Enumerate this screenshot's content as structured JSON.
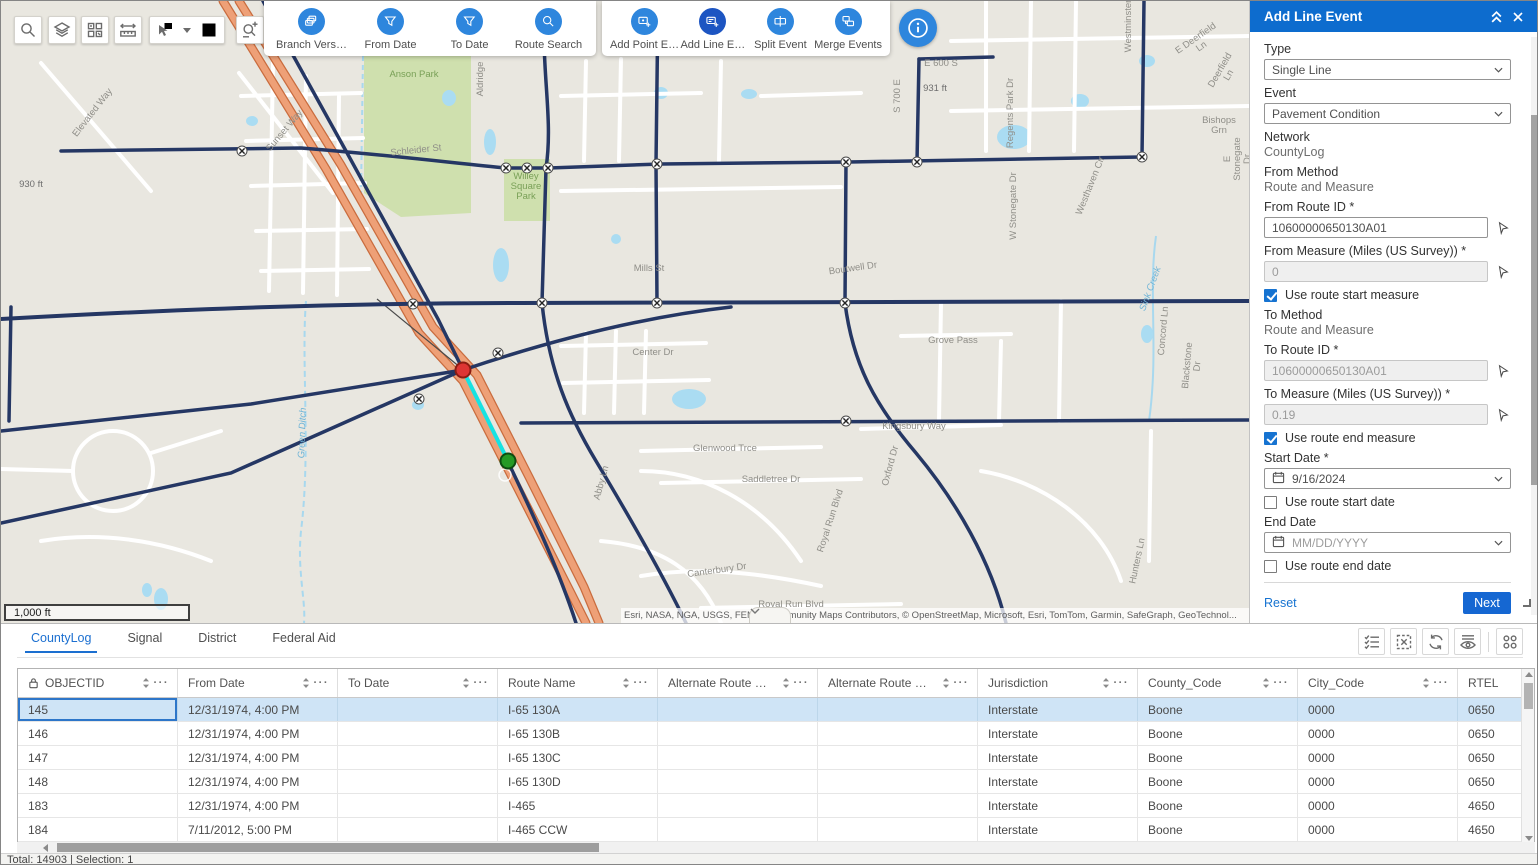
{
  "toolbar": {
    "left_tools": [
      "search-icon",
      "layers-icon",
      "basemap-grid-icon",
      "measure-icon",
      "select-icon",
      "clear-selection-icon",
      "route-sketch-icon"
    ],
    "filter_tools": [
      {
        "label": "Branch Vers…",
        "icon": "branch-version-icon"
      },
      {
        "label": "From Date",
        "icon": "filter-icon"
      },
      {
        "label": "To Date",
        "icon": "filter-icon"
      },
      {
        "label": "Route Search",
        "icon": "route-search-icon"
      }
    ],
    "event_tools": [
      {
        "label": "Add Point E…",
        "icon": "add-point-event-icon",
        "active": false
      },
      {
        "label": "Add Line E…",
        "icon": "add-line-event-icon",
        "active": true
      },
      {
        "label": "Split Event",
        "icon": "split-event-icon",
        "active": false
      },
      {
        "label": "Merge Events",
        "icon": "merge-events-icon",
        "active": false
      }
    ],
    "info_icon": "info-icon"
  },
  "map": {
    "scale_bar": "1,000 ft",
    "attribution": "Esri, NASA, NGA, USGS, FEMA | Community Maps Contributors, © OpenStreetMap, Microsoft, Esri, TomTom, Garmin, SafeGraph, GeoTechnol...",
    "labels": [
      {
        "text": "Elevated Way",
        "x": 92,
        "y": 112,
        "rot": -52,
        "cls": ""
      },
      {
        "text": "Sunset Way",
        "x": 284,
        "y": 130,
        "rot": -50,
        "cls": ""
      },
      {
        "text": "Anson Park",
        "x": 413,
        "y": 74,
        "rot": 0,
        "cls": "park"
      },
      {
        "text": "Aldridge",
        "x": 480,
        "y": 78,
        "rot": -90,
        "cls": ""
      },
      {
        "text": "Willey\nSquare\nPark",
        "x": 525,
        "y": 186,
        "rot": 0,
        "cls": "park"
      },
      {
        "text": "931 ft",
        "x": 934,
        "y": 88,
        "rot": 0,
        "cls": "elev"
      },
      {
        "text": "930 ft",
        "x": 30,
        "y": 184,
        "rot": 0,
        "cls": "elev"
      },
      {
        "text": "Schleider St",
        "x": 415,
        "y": 150,
        "rot": -6,
        "cls": ""
      },
      {
        "text": "Mills St",
        "x": 648,
        "y": 268,
        "rot": 0,
        "cls": ""
      },
      {
        "text": "Center Dr",
        "x": 652,
        "y": 352,
        "rot": 0,
        "cls": ""
      },
      {
        "text": "Boutwell Dr",
        "x": 852,
        "y": 268,
        "rot": -8,
        "cls": ""
      },
      {
        "text": "Grove Pass",
        "x": 952,
        "y": 340,
        "rot": 0,
        "cls": ""
      },
      {
        "text": "Kingsbury Way",
        "x": 913,
        "y": 426,
        "rot": 0,
        "cls": ""
      },
      {
        "text": "Glenwood Trce",
        "x": 724,
        "y": 448,
        "rot": 0,
        "cls": ""
      },
      {
        "text": "Saddletree Dr",
        "x": 770,
        "y": 479,
        "rot": 0,
        "cls": ""
      },
      {
        "text": "Abby Ln",
        "x": 601,
        "y": 482,
        "rot": -75,
        "cls": ""
      },
      {
        "text": "Canterbury Dr",
        "x": 716,
        "y": 570,
        "rot": -8,
        "cls": ""
      },
      {
        "text": "Royal Run Blvd",
        "x": 790,
        "y": 604,
        "rot": 0,
        "cls": ""
      },
      {
        "text": "Royal Run Blvd",
        "x": 830,
        "y": 520,
        "rot": -72,
        "cls": ""
      },
      {
        "text": "Oxford Dr",
        "x": 890,
        "y": 465,
        "rot": -75,
        "cls": ""
      },
      {
        "text": "Hunters Ln",
        "x": 1137,
        "y": 560,
        "rot": -78,
        "cls": ""
      },
      {
        "text": "S 700 E",
        "x": 897,
        "y": 95,
        "rot": -90,
        "cls": ""
      },
      {
        "text": "E 600 S",
        "x": 940,
        "y": 63,
        "rot": 0,
        "cls": ""
      },
      {
        "text": "Regents Park Dr",
        "x": 1010,
        "y": 112,
        "rot": -90,
        "cls": ""
      },
      {
        "text": "Westhaven Cir",
        "x": 1090,
        "y": 185,
        "rot": -68,
        "cls": ""
      },
      {
        "text": "W Stonegate Dr",
        "x": 1013,
        "y": 205,
        "rot": -90,
        "cls": ""
      },
      {
        "text": "Westminster",
        "x": 1128,
        "y": 25,
        "rot": -90,
        "cls": ""
      },
      {
        "text": "E Deerfield Ln",
        "x": 1198,
        "y": 42,
        "rot": -35,
        "cls": ""
      },
      {
        "text": "Deerfield Ln",
        "x": 1224,
        "y": 72,
        "rot": -60,
        "cls": ""
      },
      {
        "text": "Bishops Grn",
        "x": 1218,
        "y": 125,
        "rot": 0,
        "cls": ""
      },
      {
        "text": "E Stonegate Dr",
        "x": 1237,
        "y": 158,
        "rot": -90,
        "cls": ""
      },
      {
        "text": "Concord Ln",
        "x": 1163,
        "y": 330,
        "rot": -85,
        "cls": ""
      },
      {
        "text": "Blackstone Dr",
        "x": 1192,
        "y": 365,
        "rot": -85,
        "cls": ""
      },
      {
        "text": "Sink Creek",
        "x": 1150,
        "y": 288,
        "rot": -70,
        "cls": "water"
      },
      {
        "text": "Green Ditch",
        "x": 302,
        "y": 432,
        "rot": -88,
        "cls": "water"
      }
    ]
  },
  "panel": {
    "title": "Add Line Event",
    "type_label": "Type",
    "type_value": "Single Line",
    "event_label": "Event",
    "event_value": "Pavement Condition",
    "network_label": "Network",
    "network_value": "CountyLog",
    "from_method_label": "From Method",
    "from_method_value": "Route and Measure",
    "from_route_label": "From Route ID *",
    "from_route_value": "10600000650130A01",
    "from_measure_label": "From Measure (Miles (US Survey)) *",
    "from_measure_value": "0",
    "use_route_start_measure_label": "Use route start measure",
    "use_route_start_measure_checked": true,
    "to_method_label": "To Method",
    "to_method_value": "Route and Measure",
    "to_route_label": "To Route ID *",
    "to_route_value": "10600000650130A01",
    "to_measure_label": "To Measure (Miles (US Survey)) *",
    "to_measure_value": "0.19",
    "use_route_end_measure_label": "Use route end measure",
    "use_route_end_measure_checked": true,
    "start_date_label": "Start Date *",
    "start_date_value": "9/16/2024",
    "use_route_start_date_label": "Use route start date",
    "use_route_start_date_checked": false,
    "end_date_label": "End Date",
    "end_date_placeholder": "MM/DD/YYYY",
    "use_route_end_date_label": "Use route end date",
    "use_route_end_date_checked": false,
    "reset_label": "Reset",
    "next_label": "Next"
  },
  "bottom": {
    "tabs": [
      {
        "label": "CountyLog",
        "active": true
      },
      {
        "label": "Signal",
        "active": false
      },
      {
        "label": "District",
        "active": false
      },
      {
        "label": "Federal Aid",
        "active": false
      }
    ],
    "table_tools": [
      "select-records-icon",
      "clear-table-selection-icon",
      "refresh-icon",
      "show-selected-icon",
      "options-grid-icon"
    ],
    "table": {
      "columns": [
        {
          "label": "OBJECTID",
          "locked": true
        },
        {
          "label": "From Date"
        },
        {
          "label": "To Date"
        },
        {
          "label": "Route Name"
        },
        {
          "label": "Alternate Route …"
        },
        {
          "label": "Alternate Route …"
        },
        {
          "label": "Jurisdiction"
        },
        {
          "label": "County_Code"
        },
        {
          "label": "City_Code"
        },
        {
          "label": "RTEL"
        }
      ],
      "rows": [
        [
          "145",
          "12/31/1974, 4:00 PM",
          "",
          "I-65 130A",
          "",
          "",
          "Interstate",
          "Boone",
          "0000",
          "0650"
        ],
        [
          "146",
          "12/31/1974, 4:00 PM",
          "",
          "I-65 130B",
          "",
          "",
          "Interstate",
          "Boone",
          "0000",
          "0650"
        ],
        [
          "147",
          "12/31/1974, 4:00 PM",
          "",
          "I-65 130C",
          "",
          "",
          "Interstate",
          "Boone",
          "0000",
          "0650"
        ],
        [
          "148",
          "12/31/1974, 4:00 PM",
          "",
          "I-65 130D",
          "",
          "",
          "Interstate",
          "Boone",
          "0000",
          "0650"
        ],
        [
          "183",
          "12/31/1974, 4:00 PM",
          "",
          "I-465",
          "",
          "",
          "Interstate",
          "Boone",
          "0000",
          "4650"
        ],
        [
          "184",
          "7/11/2012, 5:00 PM",
          "",
          "I-465 CCW",
          "",
          "",
          "Interstate",
          "Boone",
          "0000",
          "4650"
        ]
      ],
      "selected_row_index": 0
    },
    "status": "Total: 14903 | Selection: 1"
  }
}
